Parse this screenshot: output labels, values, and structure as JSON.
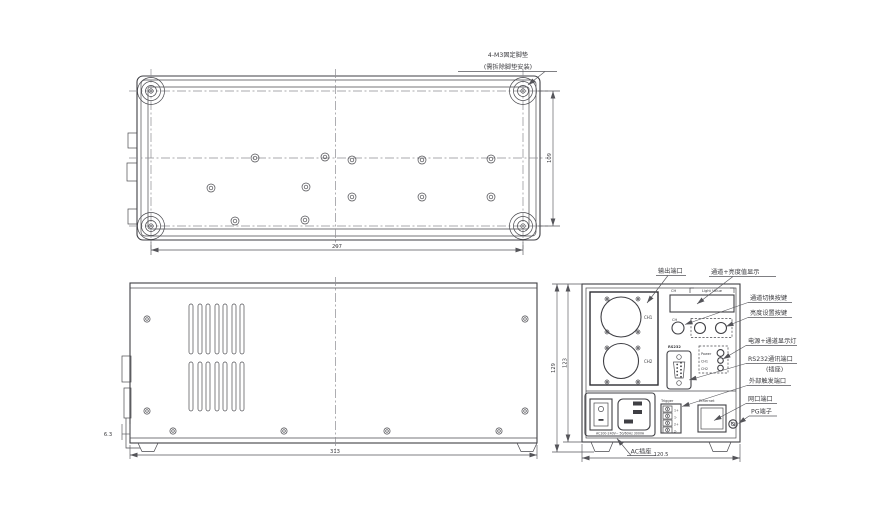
{
  "colors": {
    "line": "#3f3f44",
    "dim_text": "#7a3b3b",
    "port_label": "#4d6f9d"
  },
  "note": {
    "line1": "4-M3固定脚垫",
    "line2": "(需拆除脚垫安装)"
  },
  "dims": {
    "top_width": "297",
    "top_depth": "109",
    "side_length": "313",
    "side_offset": "6.3",
    "rear_width": "120.5",
    "rear_height_outer": "129",
    "rear_height_inner": "123"
  },
  "panel": {
    "ch1": "CH1",
    "ch2": "CH2",
    "disp_ch": "CH",
    "disp_value": "Light Value",
    "btn_ch": "CH",
    "rs232": "RS232",
    "led_power": "Power",
    "led_ch1": "CH1",
    "led_ch2": "CH2",
    "trigger": "Trigger",
    "pins": [
      "1+",
      "1-",
      "2+",
      "2-"
    ],
    "ethernet": "Ethernet",
    "rating": "AC100-240V~ 50/60Hz 300VA"
  },
  "callouts": {
    "output": "输出端口",
    "display": "通道+亮度值显示",
    "ch_switch": "通道切换按键",
    "brightness": "亮度设置按键",
    "leds": "电源+通道显示灯",
    "rs232_1": "RS232通讯端口",
    "rs232_2": "(插座)",
    "trigger": "外部触发端口",
    "lan": "网口端口",
    "pg": "PG端子",
    "ac": "AC插座"
  }
}
